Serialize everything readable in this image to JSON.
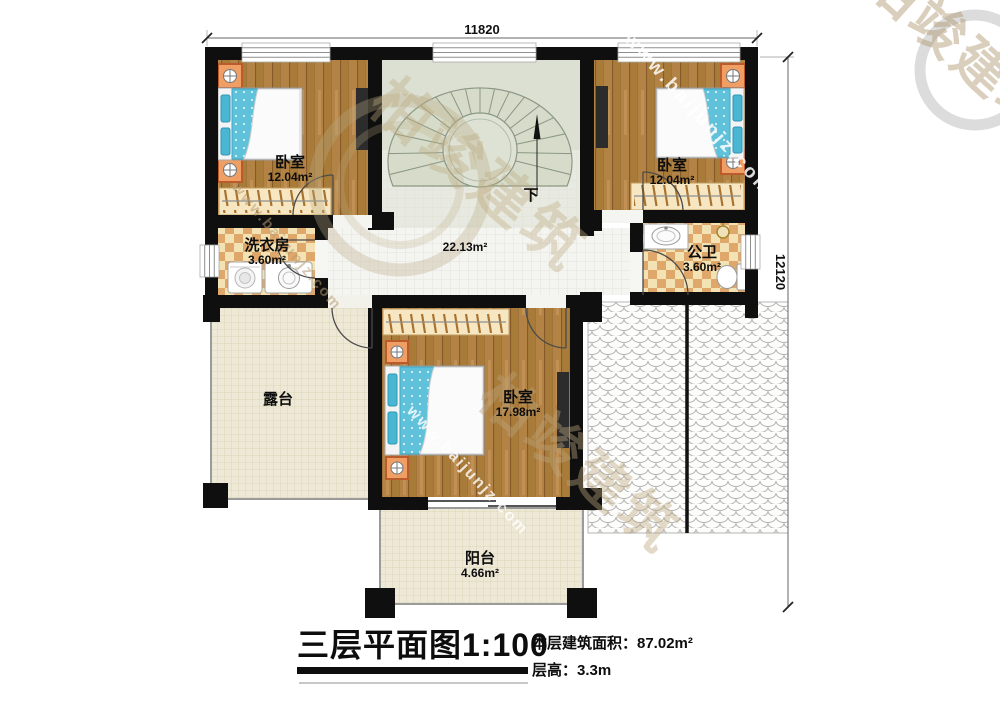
{
  "page": {
    "background": "#ffffff"
  },
  "dimensions": {
    "top": "11820",
    "right": "12120"
  },
  "rooms": {
    "bedroom_top_left": {
      "name": "卧室",
      "area": "12.04m²"
    },
    "bedroom_top_right": {
      "name": "卧室",
      "area": "12.04m²"
    },
    "laundry": {
      "name": "洗衣房",
      "area": "3.60m²"
    },
    "bathroom": {
      "name": "公卫",
      "area": "3.60m²"
    },
    "hallway": {
      "area": "22.13m²"
    },
    "bedroom_center": {
      "name": "卧室",
      "area": "17.98m²"
    },
    "terrace": {
      "name": "露台"
    },
    "balcony": {
      "name": "阳台",
      "area": "4.66m²"
    },
    "staircase": {
      "direction_label": "下"
    }
  },
  "title": {
    "main": "三层平面图1:100",
    "floor_area": "本层建筑面积：87.02m²",
    "floor_height": "层高：3.3m"
  },
  "watermark": {
    "brand": "柏竣建筑",
    "url": "www.baijunjz.com"
  },
  "colors": {
    "wall": "#0f0f0f",
    "wood_floor": "#b28345",
    "tile_accent": "#dfa76a",
    "mattress": "#60c2da",
    "floor_cream": "#eee9d6",
    "stair_floor": "#dbe0d2"
  }
}
